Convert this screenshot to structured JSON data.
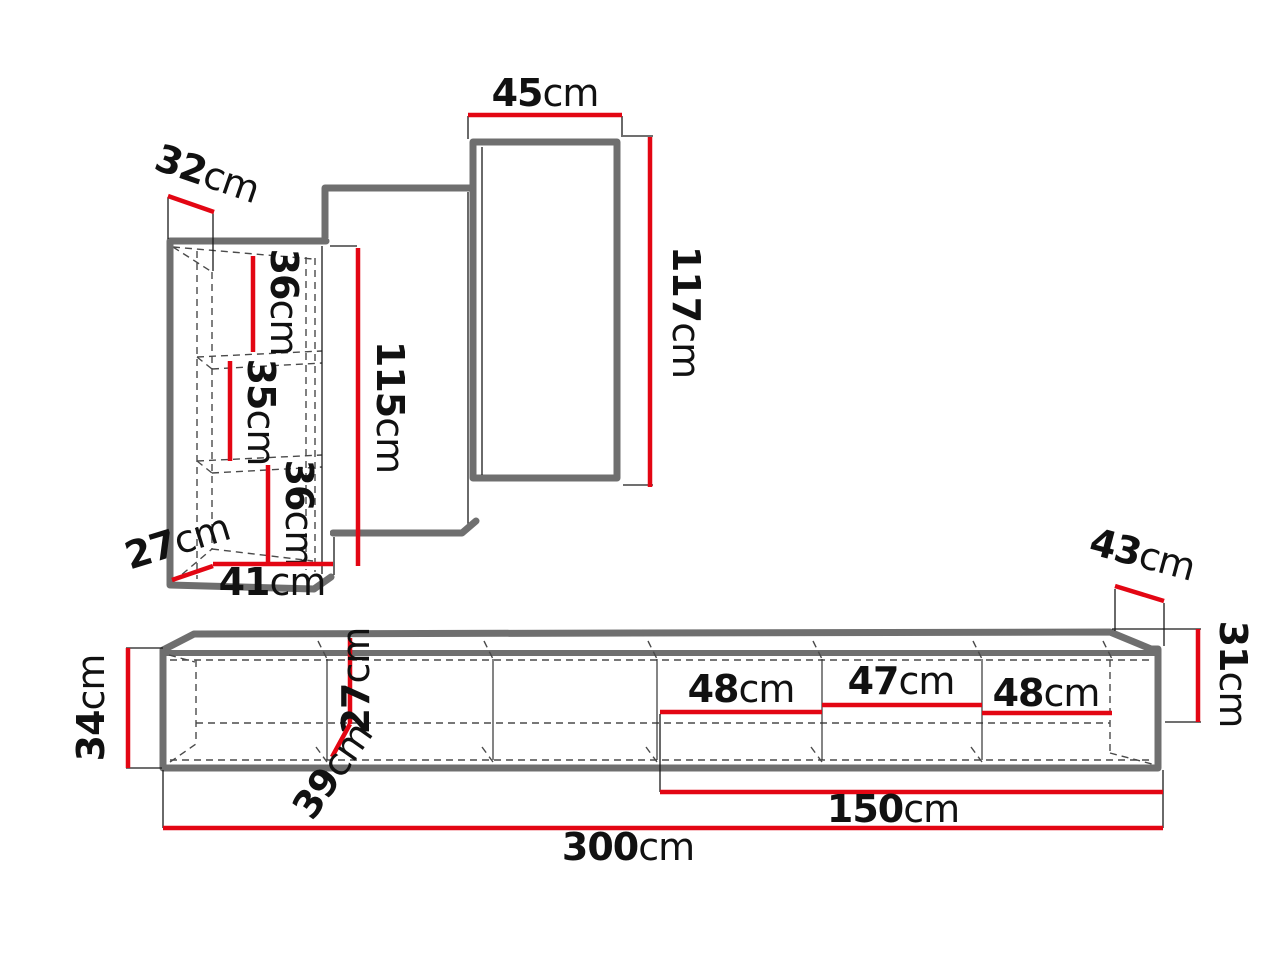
{
  "colors": {
    "dimension_red": "#e30613",
    "outline_gray": "#6f6f6f",
    "dash_gray": "#4a4a4a",
    "text": "#111111",
    "background": "#ffffff"
  },
  "diagram": {
    "type": "furniture-dimension-diagram",
    "top_assembly": {
      "cabinet": {
        "top_depth": {
          "value": "32",
          "unit": "cm"
        },
        "shelf_1": {
          "value": "36",
          "unit": "cm"
        },
        "shelf_2": {
          "value": "35",
          "unit": "cm"
        },
        "shelf_3": {
          "value": "36",
          "unit": "cm"
        },
        "height": {
          "value": "115",
          "unit": "cm"
        },
        "bottom_depth": {
          "value": "27",
          "unit": "cm"
        },
        "bottom_width": {
          "value": "41",
          "unit": "cm"
        }
      },
      "right_panel": {
        "width": {
          "value": "45",
          "unit": "cm"
        },
        "height": {
          "value": "117",
          "unit": "cm"
        }
      }
    },
    "bottom_assembly": {
      "height": {
        "value": "34",
        "unit": "cm"
      },
      "inner_height": {
        "value": "27",
        "unit": "cm"
      },
      "depth_diagonal": {
        "value": "39",
        "unit": "cm"
      },
      "compartment_1": {
        "value": "48",
        "unit": "cm"
      },
      "compartment_2": {
        "value": "47",
        "unit": "cm"
      },
      "compartment_3": {
        "value": "48",
        "unit": "cm"
      },
      "top_depth": {
        "value": "43",
        "unit": "cm"
      },
      "right_height": {
        "value": "31",
        "unit": "cm"
      },
      "half_width": {
        "value": "150",
        "unit": "cm"
      },
      "total_width": {
        "value": "300",
        "unit": "cm"
      }
    }
  }
}
